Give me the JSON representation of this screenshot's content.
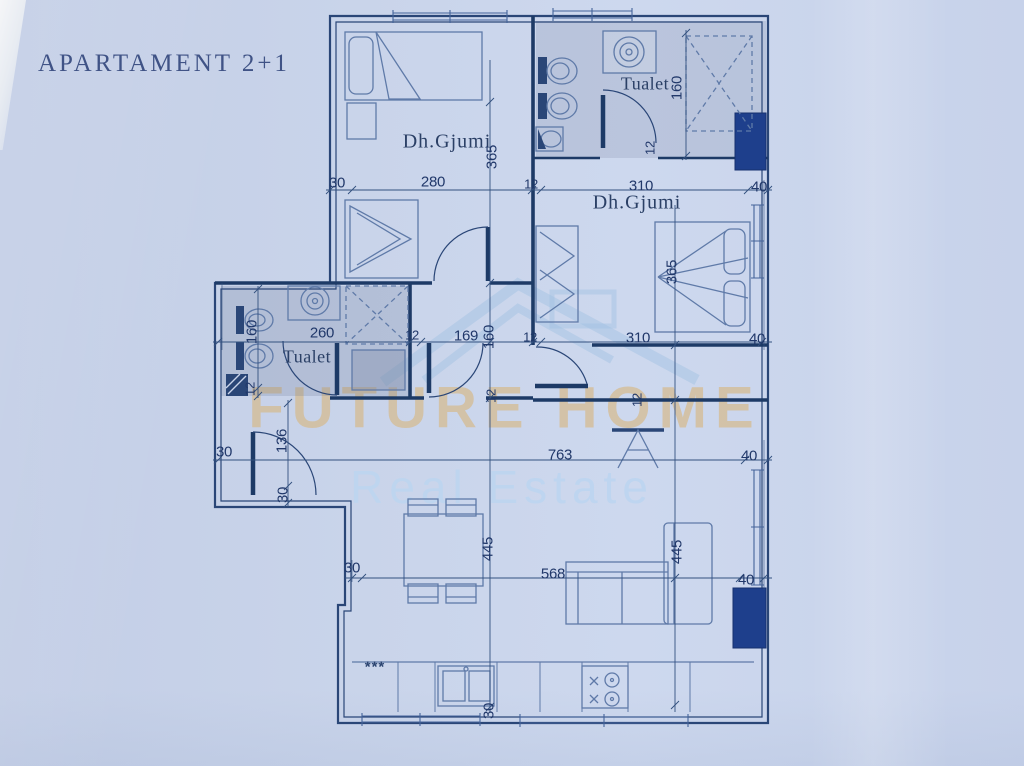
{
  "title": "APARTAMENT 2+1",
  "watermark": {
    "line1": "FUTURE HOME",
    "line2": "Real Estate"
  },
  "colors": {
    "paper": "#c9d4ea",
    "plan_line": "#2a4677",
    "wall_dark": "#1d3a66",
    "column_fill": "#1e3f8c",
    "furniture_line": "#5f7aa8",
    "dim_text": "#21386a",
    "watermark_tan": "#d6b888",
    "watermark_blue": "#bcd5f0"
  },
  "plan": {
    "room_labels": [
      {
        "text": "Dh.Gjumi",
        "x": 447,
        "y": 142,
        "rot": 0,
        "cls": "room",
        "name": "room-label-bedroom-left"
      },
      {
        "text": "Dh.Gjumi",
        "x": 637,
        "y": 203,
        "rot": 0,
        "cls": "room",
        "name": "room-label-bedroom-right"
      },
      {
        "text": "Tualet",
        "x": 645,
        "y": 84,
        "rot": 0,
        "cls": "room-sm",
        "name": "room-label-toilet-top"
      },
      {
        "text": "Tualet",
        "x": 307,
        "y": 357,
        "rot": 0,
        "cls": "room-sm",
        "name": "room-label-toilet-left"
      }
    ],
    "dim_labels": [
      {
        "text": "30",
        "x": 337,
        "y": 183,
        "rot": 0,
        "cls": "dim"
      },
      {
        "text": "280",
        "x": 433,
        "y": 182,
        "rot": 0,
        "cls": "dim"
      },
      {
        "text": "12",
        "x": 531,
        "y": 184,
        "rot": 0,
        "cls": "dim-sm"
      },
      {
        "text": "310",
        "x": 641,
        "y": 186,
        "rot": 0,
        "cls": "dim"
      },
      {
        "text": "40",
        "x": 759,
        "y": 187,
        "rot": 0,
        "cls": "dim"
      },
      {
        "text": "365",
        "x": 492,
        "y": 157,
        "rot": -90,
        "cls": "dim"
      },
      {
        "text": "160",
        "x": 677,
        "y": 88,
        "rot": -90,
        "cls": "dim"
      },
      {
        "text": "12",
        "x": 650,
        "y": 148,
        "rot": -90,
        "cls": "dim-sm"
      },
      {
        "text": "365",
        "x": 672,
        "y": 272,
        "rot": -90,
        "cls": "dim"
      },
      {
        "text": "160",
        "x": 252,
        "y": 332,
        "rot": -90,
        "cls": "dim"
      },
      {
        "text": "260",
        "x": 322,
        "y": 333,
        "rot": 0,
        "cls": "dim"
      },
      {
        "text": "12",
        "x": 412,
        "y": 335,
        "rot": 0,
        "cls": "dim-sm"
      },
      {
        "text": "169",
        "x": 466,
        "y": 336,
        "rot": 0,
        "cls": "dim"
      },
      {
        "text": "160",
        "x": 489,
        "y": 337,
        "rot": -90,
        "cls": "dim"
      },
      {
        "text": "12",
        "x": 530,
        "y": 337,
        "rot": 0,
        "cls": "dim-sm"
      },
      {
        "text": "310",
        "x": 638,
        "y": 338,
        "rot": 0,
        "cls": "dim"
      },
      {
        "text": "40",
        "x": 757,
        "y": 339,
        "rot": 0,
        "cls": "dim"
      },
      {
        "text": "12",
        "x": 250,
        "y": 389,
        "rot": -90,
        "cls": "dim-sm"
      },
      {
        "text": "12",
        "x": 491,
        "y": 396,
        "rot": -90,
        "cls": "dim-sm"
      },
      {
        "text": "12",
        "x": 637,
        "y": 400,
        "rot": -90,
        "cls": "dim-sm"
      },
      {
        "text": "136",
        "x": 282,
        "y": 441,
        "rot": -90,
        "cls": "dim"
      },
      {
        "text": "30",
        "x": 224,
        "y": 452,
        "rot": 0,
        "cls": "dim"
      },
      {
        "text": "30",
        "x": 283,
        "y": 495,
        "rot": -90,
        "cls": "dim"
      },
      {
        "text": "763",
        "x": 560,
        "y": 455,
        "rot": 0,
        "cls": "dim"
      },
      {
        "text": "40",
        "x": 749,
        "y": 456,
        "rot": 0,
        "cls": "dim"
      },
      {
        "text": "445",
        "x": 488,
        "y": 549,
        "rot": -90,
        "cls": "dim"
      },
      {
        "text": "568",
        "x": 553,
        "y": 574,
        "rot": 0,
        "cls": "dim"
      },
      {
        "text": "445",
        "x": 677,
        "y": 552,
        "rot": -90,
        "cls": "dim"
      },
      {
        "text": "40",
        "x": 746,
        "y": 580,
        "rot": 0,
        "cls": "dim"
      },
      {
        "text": "30",
        "x": 352,
        "y": 568,
        "rot": 0,
        "cls": "dim"
      },
      {
        "text": "30",
        "x": 489,
        "y": 711,
        "rot": -90,
        "cls": "dim"
      }
    ],
    "fixture_labels": [
      {
        "text": "***",
        "x": 375,
        "y": 667,
        "rot": 0,
        "cls": "fixture",
        "name": "fridge-symbol"
      }
    ]
  }
}
